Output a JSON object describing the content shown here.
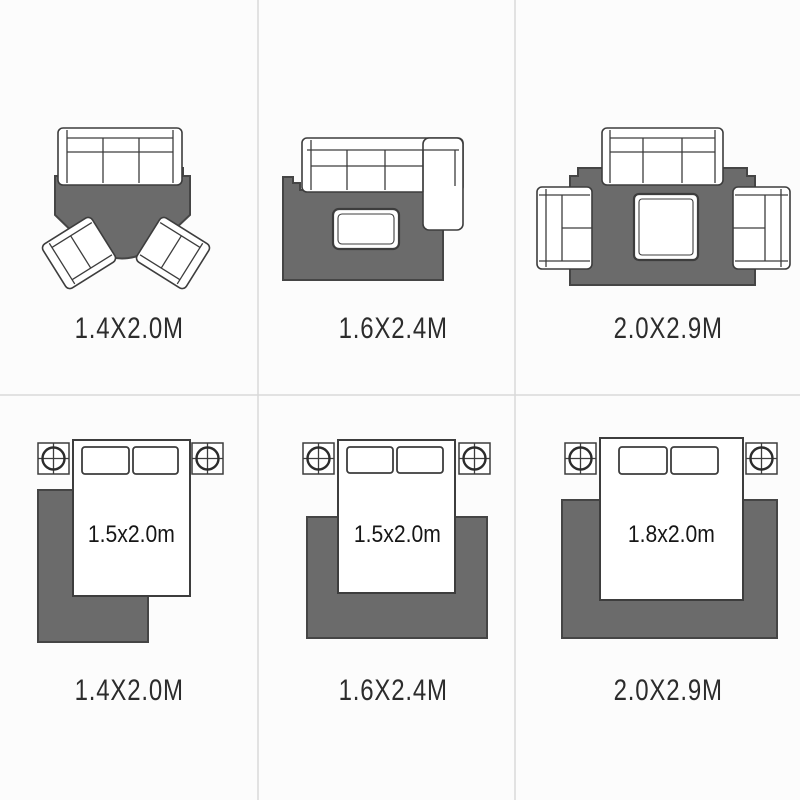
{
  "colors": {
    "background": "#fcfcfc",
    "divider": "#d9d9d9",
    "rug_fill": "#6b6b6b",
    "rug_stroke": "#454545",
    "outline": "#3d3d3d",
    "label_text": "#2c2c2c",
    "bed_label_text": "#161616"
  },
  "panels": [
    {
      "id": "living-room-armchairs",
      "scene": "sofa with two angled armchairs on notched rug",
      "rug_size": "1.4X2.0M"
    },
    {
      "id": "living-room-sectional",
      "scene": "L-shaped sectional sofa with coffee table on rug",
      "rug_size": "1.6X2.4M"
    },
    {
      "id": "living-room-three-seat",
      "scene": "sofa and two loveseats around square coffee table on rug",
      "rug_size": "2.0X2.9M"
    },
    {
      "id": "bedroom-small",
      "scene": "bed with two nightstands, rug offset to left side of bed",
      "bed_size": "1.5x2.0m",
      "rug_size": "1.4X2.0M"
    },
    {
      "id": "bedroom-medium",
      "scene": "bed with two nightstands, rug under lower half of bed",
      "bed_size": "1.5x2.0m",
      "rug_size": "1.6X2.4M"
    },
    {
      "id": "bedroom-large",
      "scene": "bed with two nightstands, wide rug under lower half of bed",
      "bed_size": "1.8x2.0m",
      "rug_size": "2.0X2.9M"
    }
  ]
}
